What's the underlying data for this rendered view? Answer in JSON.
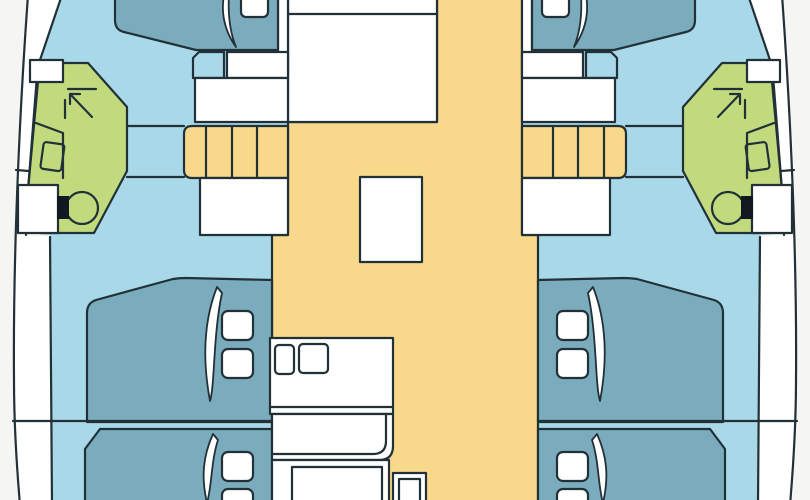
{
  "page": {
    "title": "Catamaran interior deck floor plan",
    "diagram_type": "boat-floor-plan",
    "orientation": "bow-at-top, cropped at top and bottom edges"
  },
  "colors": {
    "background": "#f5f5f4",
    "deck_white": "#ffffff",
    "cabin_floor_blue": "#a9d9e8",
    "berth_teal": "#7aacbd",
    "bathroom_green": "#c2da7e",
    "salon_floor_yellow": "#f8d88a",
    "outline": "#223038",
    "fixture_black": "#101820"
  },
  "rooms": [
    {
      "name": "forward-port-cabin",
      "type": "cabin",
      "features": [
        "double-berth",
        "pillow",
        "step-box",
        "dresser"
      ]
    },
    {
      "name": "forward-starboard-cabin",
      "type": "cabin",
      "features": [
        "double-berth",
        "pillow",
        "step-box",
        "dresser"
      ]
    },
    {
      "name": "port-bathroom",
      "type": "head",
      "features": [
        "shower",
        "sink",
        "toilet"
      ]
    },
    {
      "name": "starboard-bathroom",
      "type": "head",
      "features": [
        "shower",
        "sink",
        "toilet"
      ]
    },
    {
      "name": "salon",
      "type": "saloon",
      "features": [
        "table",
        "forward-console"
      ]
    },
    {
      "name": "galley",
      "type": "galley",
      "features": [
        "double-sink",
        "counters",
        "stove-block"
      ]
    },
    {
      "name": "port-companionway-stairs",
      "type": "stairs",
      "steps_visible": 4
    },
    {
      "name": "starboard-companionway-stairs",
      "type": "stairs",
      "steps_visible": 4
    },
    {
      "name": "aft-port-cabin-1",
      "type": "cabin",
      "features": [
        "double-berth",
        "two-pillows"
      ]
    },
    {
      "name": "aft-port-cabin-2",
      "type": "cabin",
      "features": [
        "double-berth",
        "two-pillows"
      ]
    },
    {
      "name": "aft-starboard-cabin-1",
      "type": "cabin",
      "features": [
        "double-berth",
        "two-pillows"
      ]
    },
    {
      "name": "aft-starboard-cabin-2",
      "type": "cabin",
      "features": [
        "double-berth",
        "two-pillows"
      ]
    },
    {
      "name": "port-side-deck",
      "type": "deck"
    },
    {
      "name": "starboard-side-deck",
      "type": "deck"
    }
  ],
  "fixture_icons": [
    "shower-arrow-icon",
    "toilet-icon",
    "sink-icon",
    "berth-pillow",
    "berth-drape",
    "stair-treads"
  ]
}
